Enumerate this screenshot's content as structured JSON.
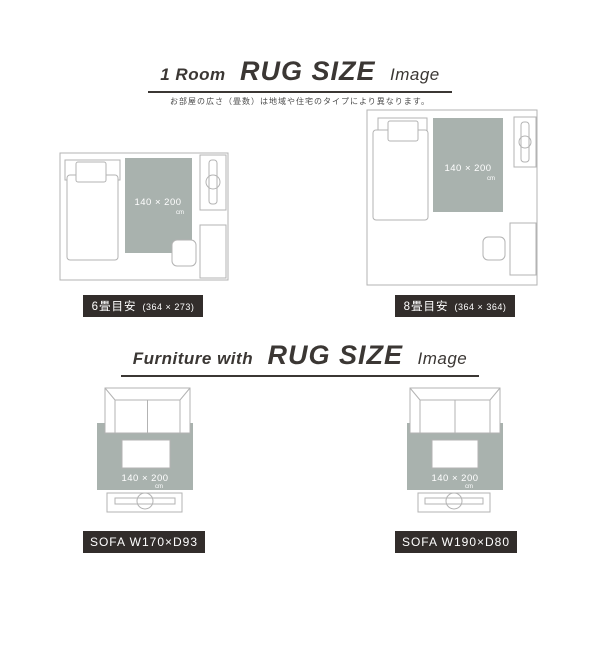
{
  "colors": {
    "rug": "#a9b2ae",
    "badge_bg": "#322d2b",
    "line": "#b3b3b3",
    "title": "#3b3734"
  },
  "section_room": {
    "title_prefix": "1 Room",
    "title_main": "RUG SIZE",
    "title_suffix": "Image",
    "subtitle": "お部屋の広さ（畳数）は地域や住宅のタイプにより異なります。",
    "rooms": [
      {
        "rug_size": "140 × 200",
        "rug_unit": "cm",
        "badge_label": "6畳目安",
        "badge_dims": "(364 × 273)"
      },
      {
        "rug_size": "140 × 200",
        "rug_unit": "cm",
        "badge_label": "8畳目安",
        "badge_dims": "(364 × 364)"
      }
    ]
  },
  "section_furniture": {
    "title_prefix": "Furniture with",
    "title_main": "RUG SIZE",
    "title_suffix": "Image",
    "sofas": [
      {
        "rug_size": "140 × 200",
        "rug_unit": "cm",
        "badge_label": "SOFA W170×D93"
      },
      {
        "rug_size": "140 × 200",
        "rug_unit": "cm",
        "badge_label": "SOFA W190×D80"
      }
    ]
  }
}
